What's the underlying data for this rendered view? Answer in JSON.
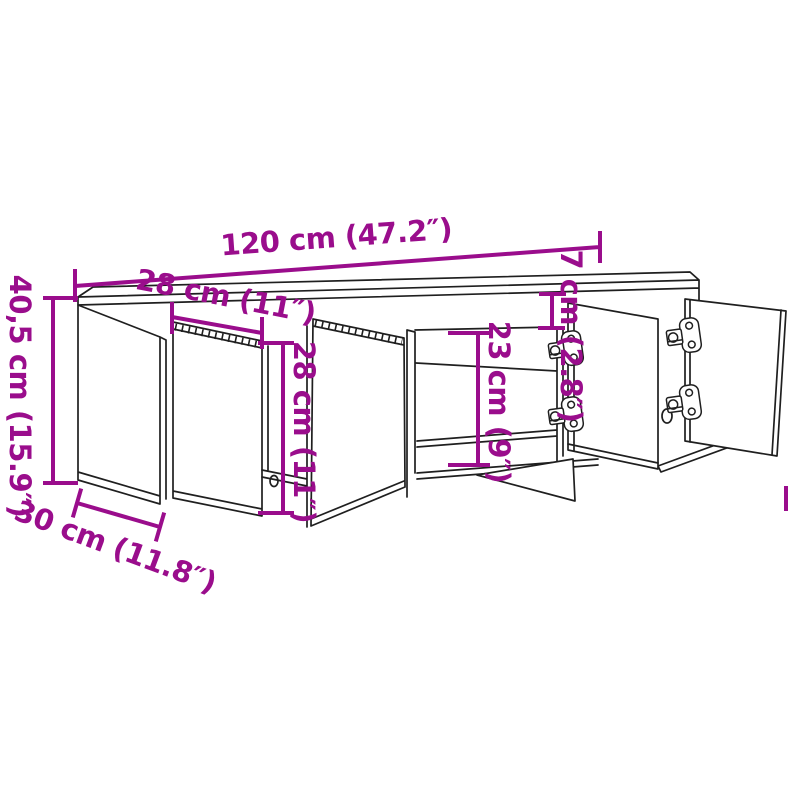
{
  "diagram": {
    "colors": {
      "dimension_accent": "#9a0d8c",
      "drawing_line": "#1f1f1f",
      "background": "#ffffff"
    },
    "dimensions": {
      "overall_width": "120 cm (47.2″)",
      "door_width": "28 cm (11″)",
      "overall_height": "40,5 cm (15.9″)",
      "overall_depth": "30 cm (11.8″)",
      "door_height": "28 cm (11″)",
      "compartment_height": "23 cm (9″)",
      "top_clearance": "7 cm (2.8″)"
    }
  }
}
